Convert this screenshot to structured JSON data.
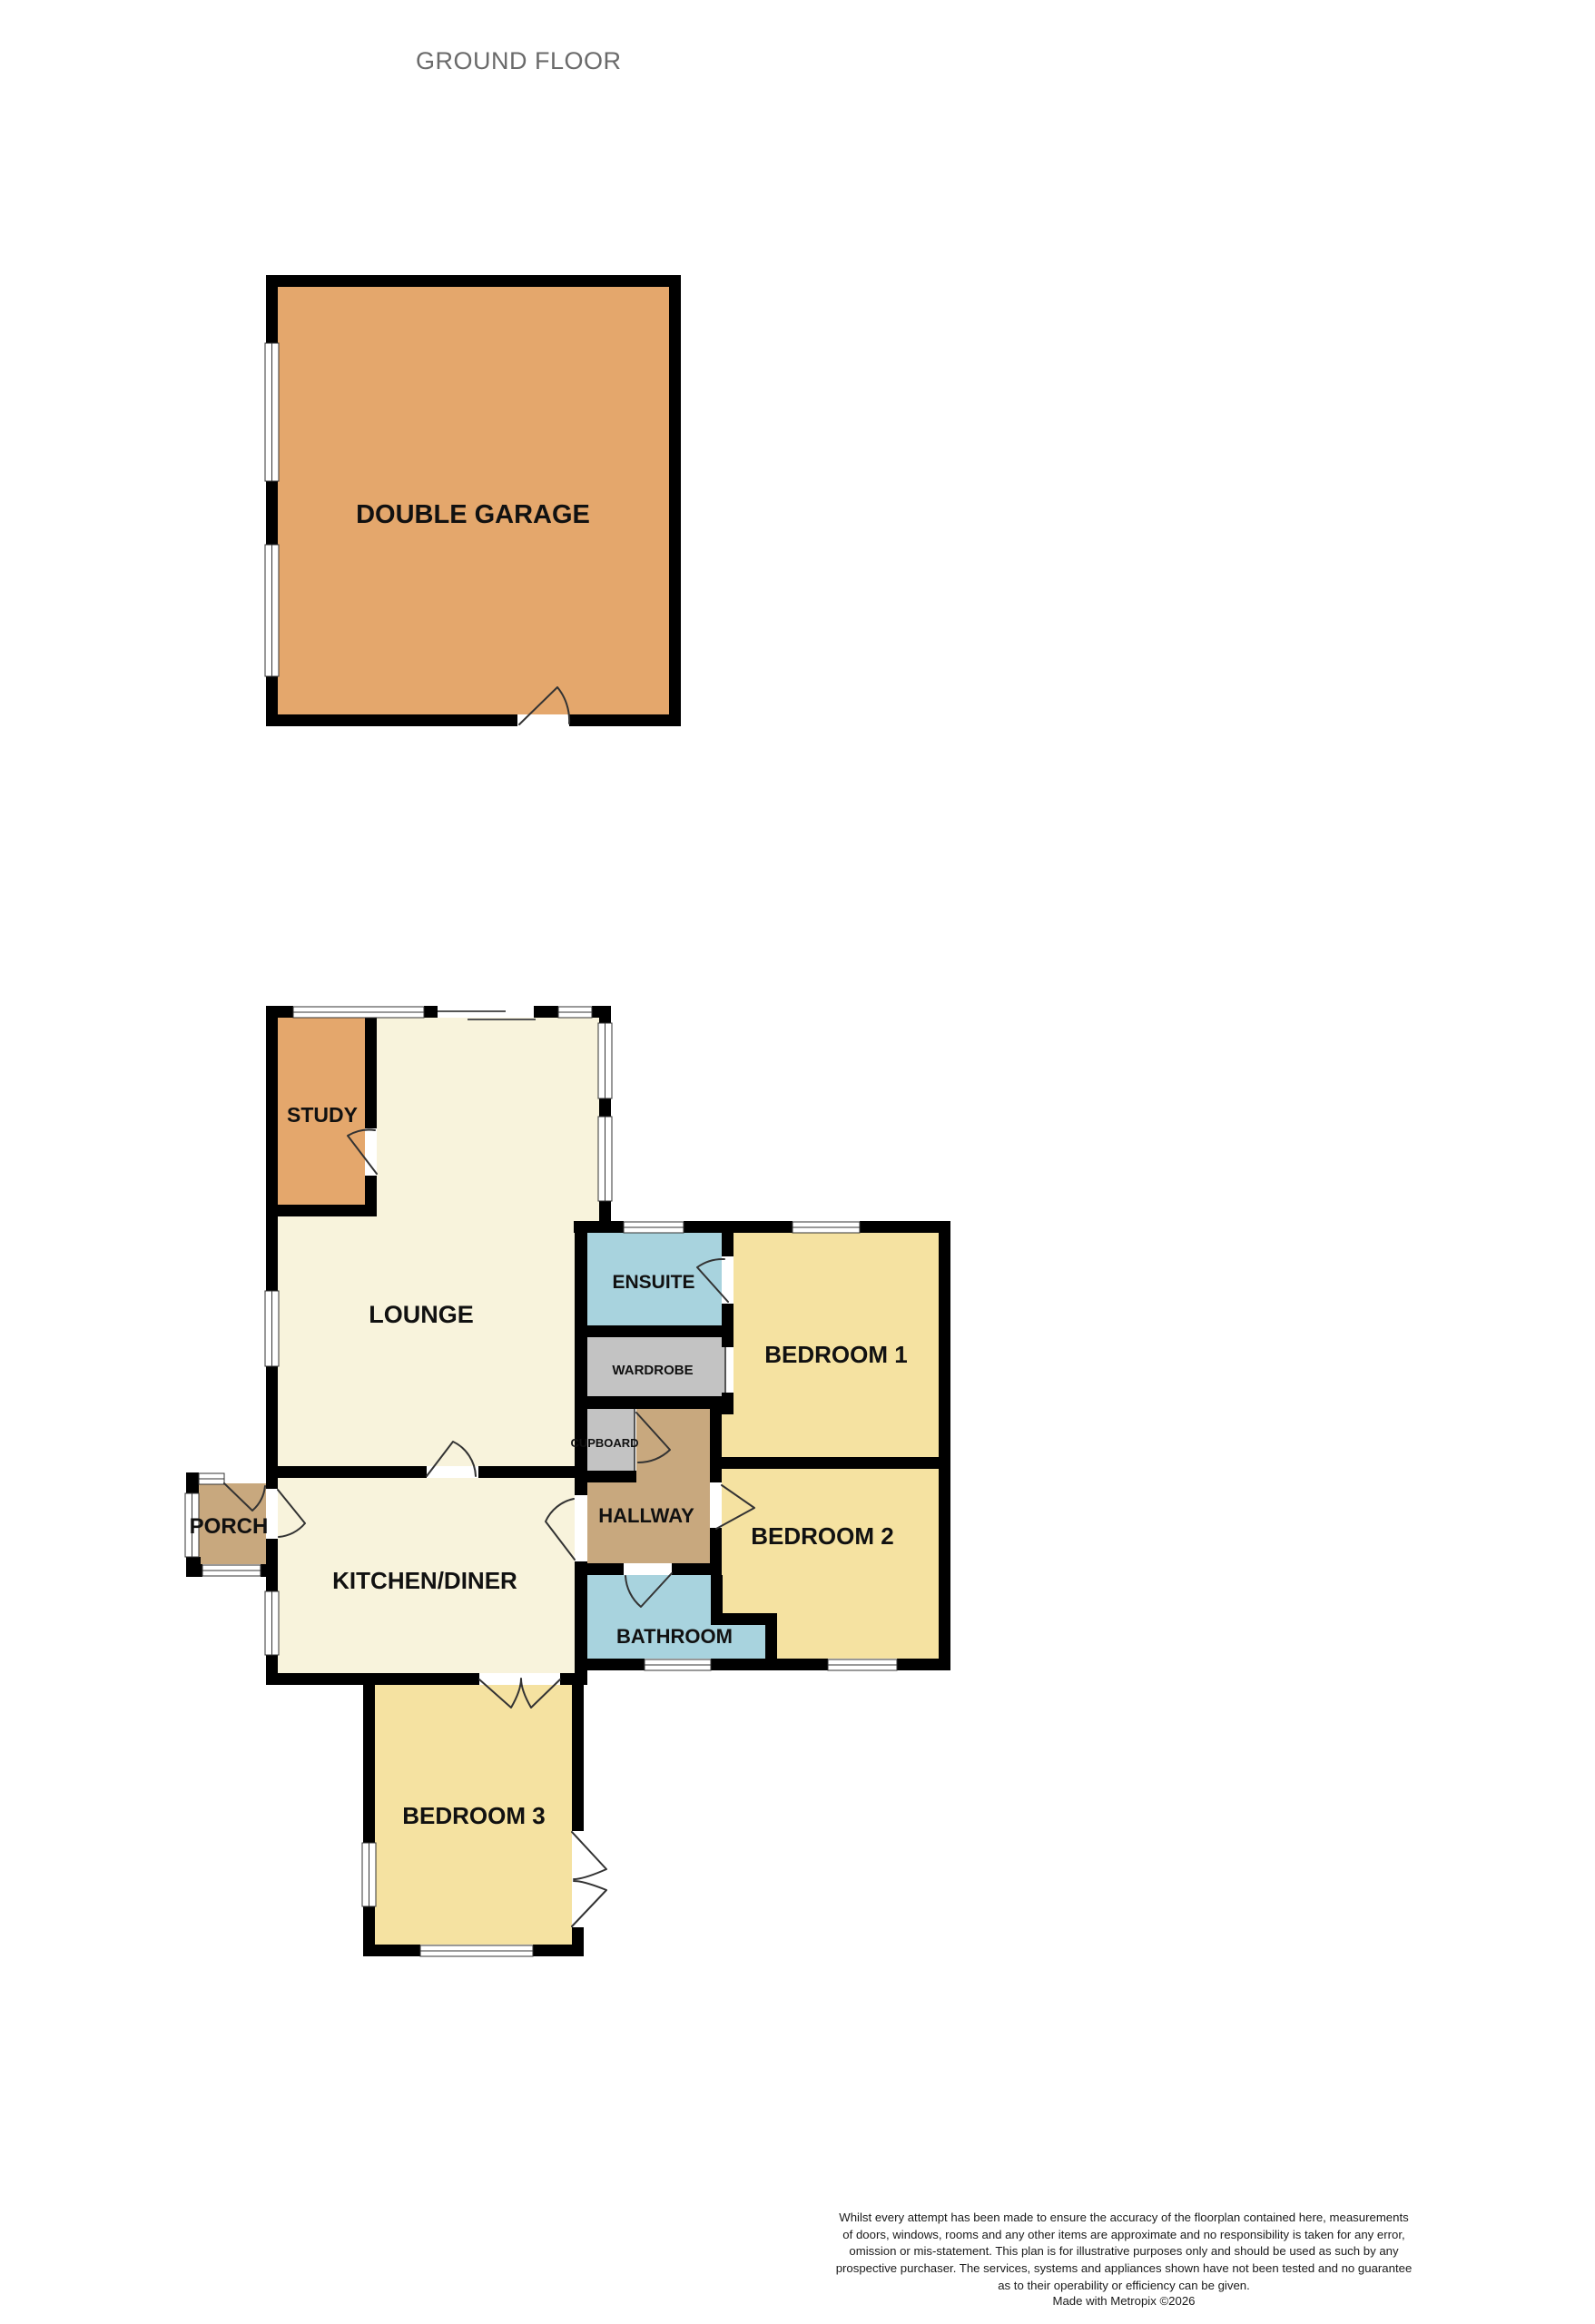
{
  "title": "GROUND FLOOR",
  "rooms": {
    "garage": {
      "label": "DOUBLE GARAGE"
    },
    "study": {
      "label": "STUDY"
    },
    "lounge": {
      "label": "LOUNGE"
    },
    "ensuite": {
      "label": "ENSUITE"
    },
    "wardrobe": {
      "label": "WARDROBE"
    },
    "bedroom1": {
      "label": "BEDROOM 1"
    },
    "cupboard": {
      "label": "CUPBOARD"
    },
    "hallway": {
      "label": "HALLWAY"
    },
    "bedroom2": {
      "label": "BEDROOM 2"
    },
    "porch": {
      "label": "PORCH"
    },
    "kitchen": {
      "label": "KITCHEN/DINER"
    },
    "bathroom": {
      "label": "BATHROOM"
    },
    "bedroom3": {
      "label": "BEDROOM 3"
    }
  },
  "colors": {
    "garage": "#e4a76c",
    "study": "#e4a76c",
    "lounge": "#f8f3dc",
    "kitchen": "#f8f3dc",
    "porch": "#c8a87e",
    "hallway": "#c8a87e",
    "bedroom": "#f5e2a1",
    "ensuite": "#a8d3de",
    "bathroom": "#a8d3de",
    "wardrobe": "#c3c3c3",
    "cupboard": "#c3c3c3",
    "wall": "#000000",
    "label": "#111111",
    "title": "#6a6a6a"
  },
  "footer": {
    "disclaimer": "Whilst every attempt has been made to ensure the accuracy of the floorplan contained here, measurements\nof doors, windows, rooms and any other items are approximate and no responsibility is taken for any error,\nomission or mis-statement. This plan is for illustrative purposes only and should be used as such by any\nprospective purchaser. The services, systems and appliances shown have not been tested and no guarantee\nas to their operability or efficiency can be given.",
    "credit": "Made with Metropix ©2026"
  }
}
